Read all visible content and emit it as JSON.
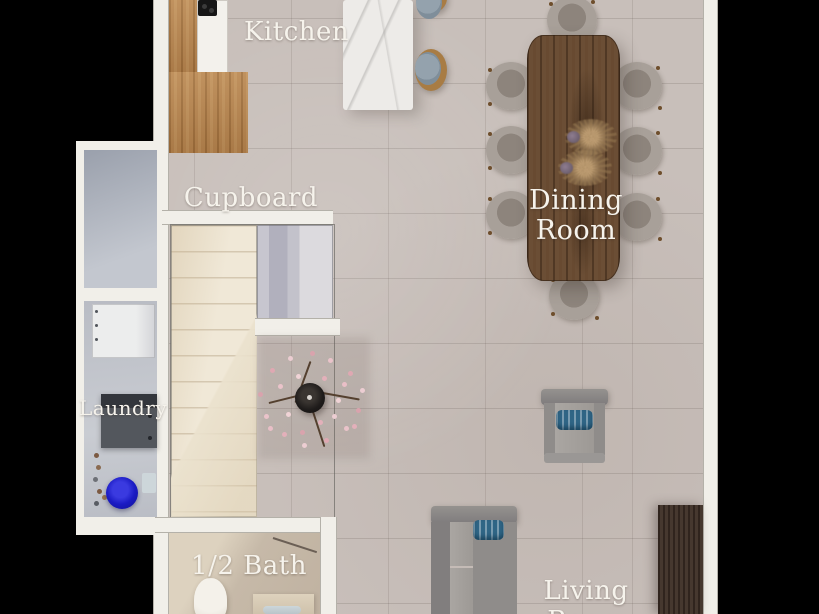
{
  "labels": {
    "kitchen": "Kitchen",
    "cupboard": "Cupboard",
    "dining_line1": "Dining",
    "dining_line2": "Room",
    "laundry": "Laundry",
    "half_bath": "1/2 Bath",
    "living_room": "Living Room"
  },
  "colors": {
    "background": "#000000",
    "floor_tile": "#c8bfba",
    "wall_white": "#f1efe9",
    "label_text": "#f6f3ec",
    "kitchen_counter_wood": "#b5834e",
    "island_marble": "#edebe8",
    "dining_table_wood": "#6b4e35",
    "dining_chair_gray": "#a8a099",
    "stairs_cream": "#f0e8d7",
    "cupboard_closet": "#b1b0bd",
    "sofa_gray": "#8f8c8a",
    "pillow_blue": "#2f6585",
    "laundry_tub_blue": "#1b1bc4",
    "console_dark_wood": "#46382f",
    "blossom_pink": "#e9bfc7"
  },
  "furniture": {
    "dining_chairs_count": 8,
    "bar_stools_count": 2,
    "items": [
      "kitchen counter with cooktop",
      "marble kitchen island",
      "bar stools",
      "dining table",
      "dried flower centerpieces",
      "dining chairs",
      "blossom plant in pot",
      "staircase",
      "cupboard closet",
      "storage room",
      "laundry cabinet",
      "washing machine",
      "laundry tub",
      "toilet",
      "bathroom vanity with sink",
      "armchair",
      "sofa",
      "media console"
    ]
  }
}
